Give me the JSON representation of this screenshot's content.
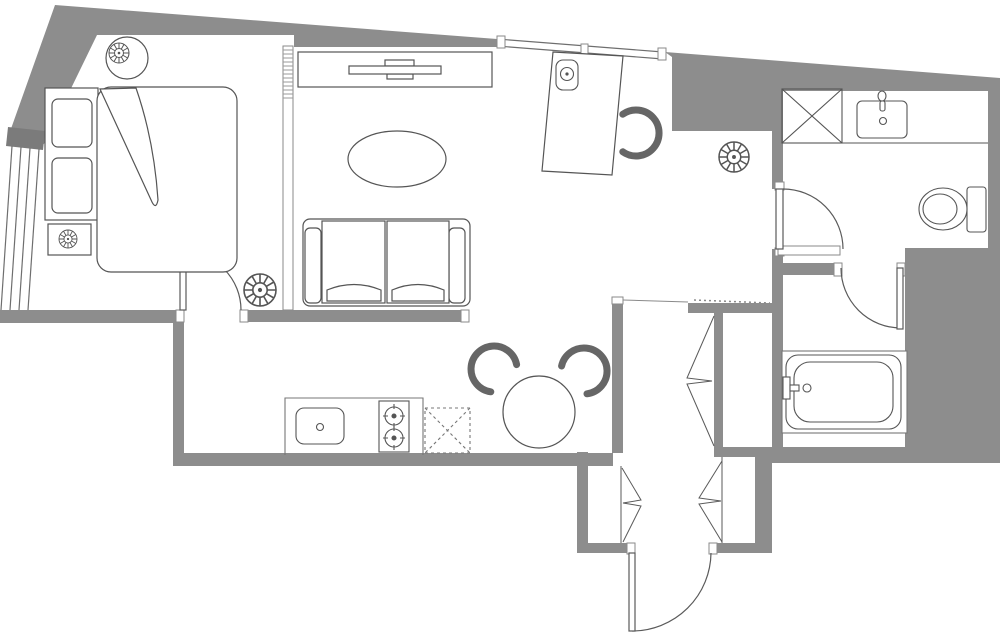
{
  "plan": {
    "type": "apartment-floor-plan",
    "canvas": {
      "width": 1000,
      "height": 634
    },
    "colors": {
      "background": "#ffffff",
      "wall": "#8d8d8d",
      "wall_dark": "#7b7b7b",
      "line": "#4f4f4f",
      "line_light": "#8a8a8a",
      "furniture": "#555555"
    },
    "rooms": [
      {
        "name": "bedroom"
      },
      {
        "name": "living-room"
      },
      {
        "name": "work-area"
      },
      {
        "name": "kitchen"
      },
      {
        "name": "dining-area"
      },
      {
        "name": "hallway"
      },
      {
        "name": "entry"
      },
      {
        "name": "bathroom-wc"
      },
      {
        "name": "bathroom-tub"
      },
      {
        "name": "closet",
        "count": 3
      }
    ],
    "furniture": [
      "double-bed",
      "pillows",
      "headboard",
      "blanket-fold",
      "nightstand",
      "bedside-table",
      "table-lamp",
      "ceiling-light",
      "tv-console",
      "tv",
      "wall-partition",
      "sofa",
      "coffee-table",
      "desk",
      "desk-chair",
      "desk-phone",
      "dining-table",
      "dining-chair",
      "kitchen-counter",
      "kitchen-sink",
      "cooktop",
      "appliance-space",
      "vanity-counter",
      "washbasin",
      "shower-box",
      "toilet",
      "bathtub",
      "bifold-door",
      "swing-door",
      "window"
    ]
  }
}
